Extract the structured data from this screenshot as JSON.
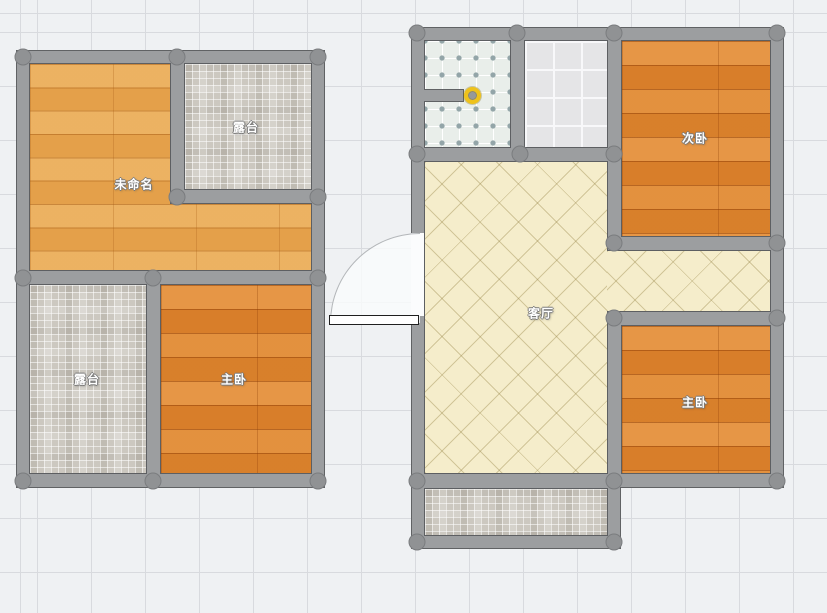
{
  "rooms": {
    "unnamed": {
      "label": "未命名"
    },
    "terrace_top": {
      "label": "露台"
    },
    "terrace_bottom": {
      "label": "露台"
    },
    "master_left": {
      "label": "主卧"
    },
    "second_bedroom": {
      "label": "次卧"
    },
    "living_room": {
      "label": "客厅"
    },
    "master_right": {
      "label": "主卧"
    }
  },
  "colors": {
    "canvas_background": "#eff1f3",
    "grid_line": "#d8dade",
    "wall": "#9c9ea0",
    "wall_outline": "#606264",
    "wall_joint": "#909294",
    "wood_floor_light": "#e9a751",
    "wood_floor_dark": "#e0862f",
    "mosaic_tile": "#ccc8c0",
    "bathroom_tile": "#e9eeea",
    "white_tile": "#e5e5e7",
    "living_tile": "#f5edcb",
    "door_leaf": "#ffffff",
    "wall_endpoint_handle": "#eec21c",
    "room_label_text": "#ffffff"
  }
}
